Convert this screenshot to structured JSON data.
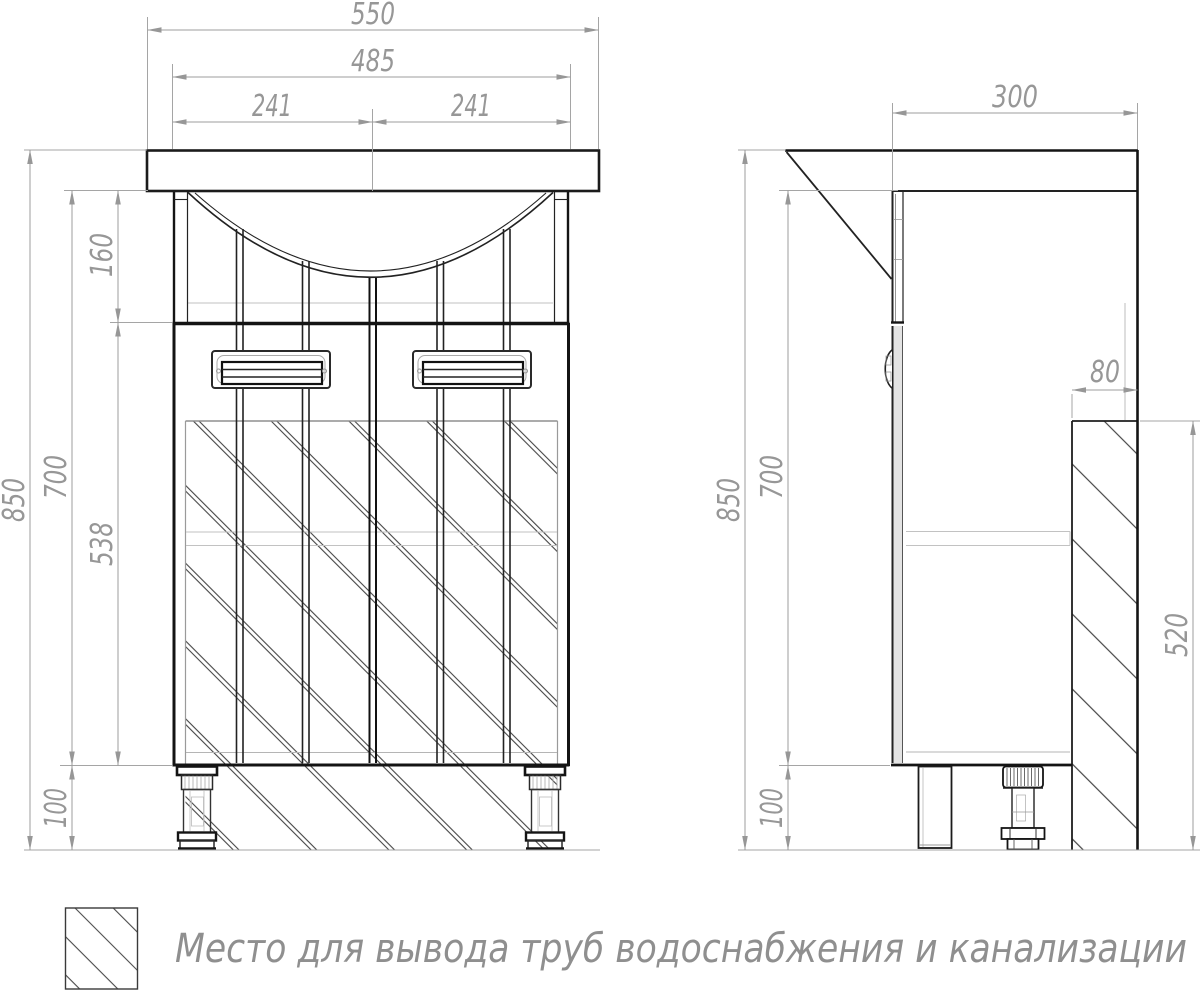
{
  "drawing": {
    "front_view": {
      "dim_overall_width": "550",
      "dim_basin_width": "485",
      "dim_basin_half_left": "241",
      "dim_basin_half_right": "241",
      "dim_total_height": "850",
      "dim_body_height": "700",
      "dim_apron_height": "160",
      "dim_door_height": "538",
      "dim_leg_height": "100"
    },
    "side_view": {
      "dim_depth": "300",
      "dim_total_height": "850",
      "dim_body_height": "700",
      "dim_leg_height": "100",
      "dim_pipe_zone_width": "80",
      "dim_pipe_zone_height": "520"
    },
    "legend": {
      "label": "Место для вывода труб водоснабжения и канализации"
    },
    "colors": {
      "line_dark": "#141414",
      "line_light": "#c2c2c2",
      "dimension": "#979797",
      "hatch": "#454545",
      "background": "#ffffff"
    }
  }
}
